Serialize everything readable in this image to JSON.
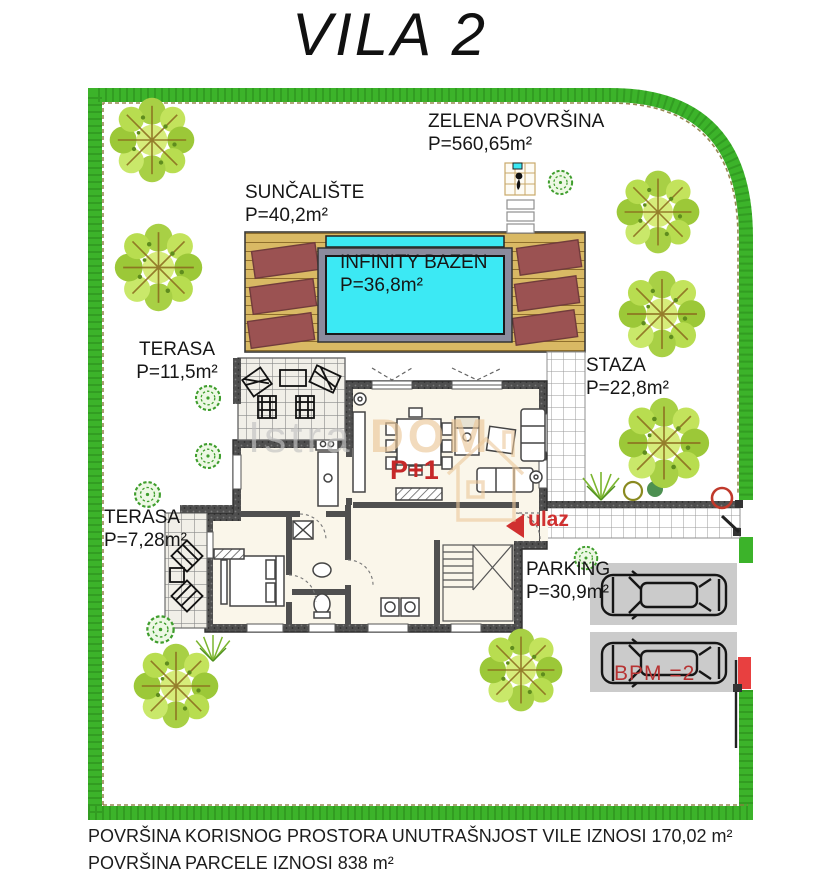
{
  "title": "VILA 2",
  "labels": {
    "zelena": {
      "name": "ZELENA POVRŠINA",
      "area": "P=560,65m²"
    },
    "suncaliste": {
      "name": "SUNČALIŠTE",
      "area": "P=40,2m²"
    },
    "bazen": {
      "name": "INFINITY BAZEN",
      "area": "P=36,8m²"
    },
    "terasa_gornja": {
      "name": "TERASA",
      "area": "P=11,5m²"
    },
    "staza": {
      "name": "STAZA",
      "area": "P=22,8m²"
    },
    "terasa_donja": {
      "name": "TERASA",
      "area": "P=7,28m²"
    },
    "parking": {
      "name": "PARKING",
      "area": "P=30,9m²"
    },
    "etaza": "P+1",
    "ulaz": "ulaz",
    "bpm": "BPM =2"
  },
  "watermark": {
    "first": "Istra",
    "second": "DOM"
  },
  "footer": {
    "line1": "POVRŠINA KORISNOG PROSTORA UNUTRAŠNJOST VILE IZNOSI 170,02 m²",
    "line2": "POVRŠINA PARCELE IZNOSI 838 m²"
  },
  "colors": {
    "hedge_green": "#3cb32a",
    "pool_water": "#3ce9f4",
    "deck_wood": "#d9b964",
    "sun_lounger": "#9b5252",
    "wall_gray": "#4f4f4f",
    "accent_red": "#c62828",
    "parking_pad": "#cbcbcb",
    "watermark_orange": "#ecc89a"
  }
}
